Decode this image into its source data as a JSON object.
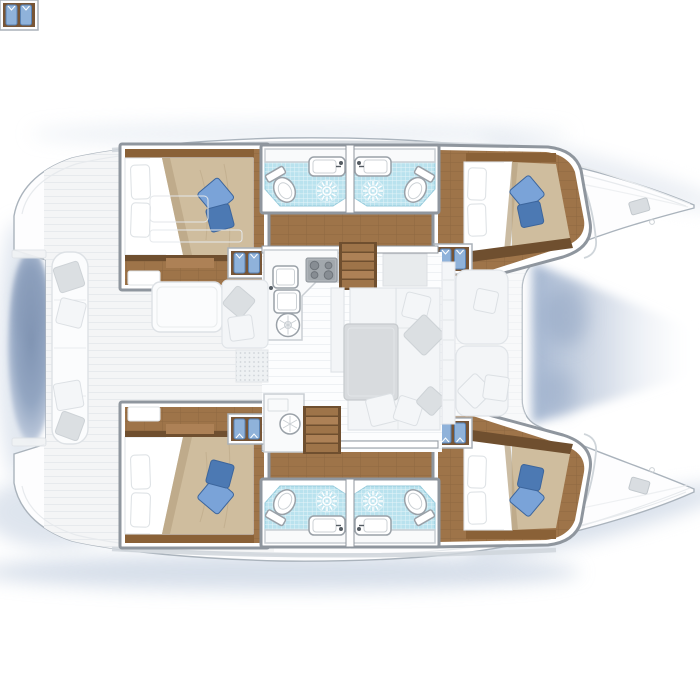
{
  "meta": {
    "title": "Catamaran yacht floor plan — overhead deck and accommodation layout, bow pointing right",
    "view": "top-down naval architecture plan",
    "visible_text": "none"
  },
  "colors": {
    "wallStroke": "#8f969e",
    "hullFill": "#fdfdfe",
    "hullStroke": "#aab3bc",
    "deckFill": "#f4f5f6",
    "deckLine": "#e7eaed",
    "salonFloor": "#fcfdfe",
    "salonLine": "#eef1f4",
    "coachroofBand": "#cfd5da",
    "woodFloor": "#9e7449",
    "woodSeam": "#8d6740",
    "woodLight": "#ad8156",
    "woodTrim": "#6f4f2f",
    "headboard": "#8a6137",
    "duvet": "#cfbd9e",
    "duvetShade": "#b9a584",
    "crease": "#c3b090",
    "linenEdge": "#dfe3e6",
    "pillowBlueLight": "#7aa3d8",
    "pillowBlueDark": "#4c79b3",
    "pillowBlueStroke": "#3c659c",
    "tile": "#b9e2ee",
    "tileEdge": "#94cadb",
    "fixtureStroke": "#9aa1a8",
    "fixtureInner": "#ccd1d5",
    "counter": "#f9fafb",
    "counterStroke": "#c9ced3",
    "appliance": "#aeb3b8",
    "applianceStroke": "#8f959b",
    "burner": "#878d93",
    "burnerStroke": "#6f757b",
    "shirtBlue": "#8fb2da",
    "shirtEdge": "#5a83b4",
    "sofa": "#f3f5f7",
    "sofaStroke": "#e0e4e8",
    "grayPillow": "#dbdfe2",
    "table": "#d8dbde",
    "tableStroke": "#c6cacd",
    "benchFill": "#fbfcfd",
    "benchStroke": "#dde1e5",
    "matDot": "#cfd4d9",
    "waterDeep": "#7f93b2",
    "waterMid": "#93a6c2",
    "waterLight": "#b7c4d8",
    "waterFade": "#dfe6f0",
    "trampoline": "#9fb2ce",
    "shadow": "#c9d4e3"
  },
  "vessel": {
    "type": "sailing catamaran",
    "hulls": 2,
    "orientation": "bows to the right, sterns to the left"
  },
  "inventory": {
    "cabins": [
      {
        "id": "port-aft-cabin",
        "position": "top-left",
        "bed": "double berth",
        "white_pillows": 2,
        "blue_accent_pillows": 2,
        "wardrobe_with_shirts": true
      },
      {
        "id": "port-forward-cabin",
        "position": "top-right",
        "bed": "double berth",
        "white_pillows": 2,
        "blue_accent_pillows": 2,
        "wardrobe_with_shirts": true
      },
      {
        "id": "starboard-aft-cabin",
        "position": "bottom-left",
        "bed": "double berth",
        "white_pillows": 2,
        "blue_accent_pillows": 2,
        "wardrobe_with_shirts": true
      },
      {
        "id": "starboard-forward-cabin",
        "position": "bottom-right",
        "bed": "double berth",
        "white_pillows": 2,
        "blue_accent_pillows": 2,
        "wardrobe_with_shirts": true
      }
    ],
    "heads": [
      {
        "id": "port-aft-head",
        "fixtures": [
          "toilet",
          "washbasin",
          "shower-drain on blue tile"
        ]
      },
      {
        "id": "port-forward-head",
        "fixtures": [
          "toilet",
          "washbasin",
          "shower-drain on blue tile"
        ]
      },
      {
        "id": "starboard-aft-head",
        "fixtures": [
          "toilet",
          "washbasin",
          "shower-drain on blue tile"
        ]
      },
      {
        "id": "starboard-forward-head",
        "fixtures": [
          "toilet",
          "washbasin",
          "shower-drain on blue tile"
        ]
      }
    ],
    "salon": [
      "L-shaped galley counter",
      "4-burner stove",
      "double sink",
      "round vent hatch",
      "dinette table",
      "wrap-around sofa with cushions",
      "chart console",
      "2 companionway stair sets"
    ],
    "aft_cockpit": [
      "curved transom bench with 4 scatter cushions",
      "cockpit table",
      "side seat with 2 cushions",
      "dotted boarding mat",
      "deck hatch outlines"
    ],
    "foredeck": [
      "forward cockpit bench with 2 sun cushions and 3 pillows",
      "trampoline water gap between bows",
      "2 deck hatches",
      "stern water gap between transoms"
    ]
  }
}
